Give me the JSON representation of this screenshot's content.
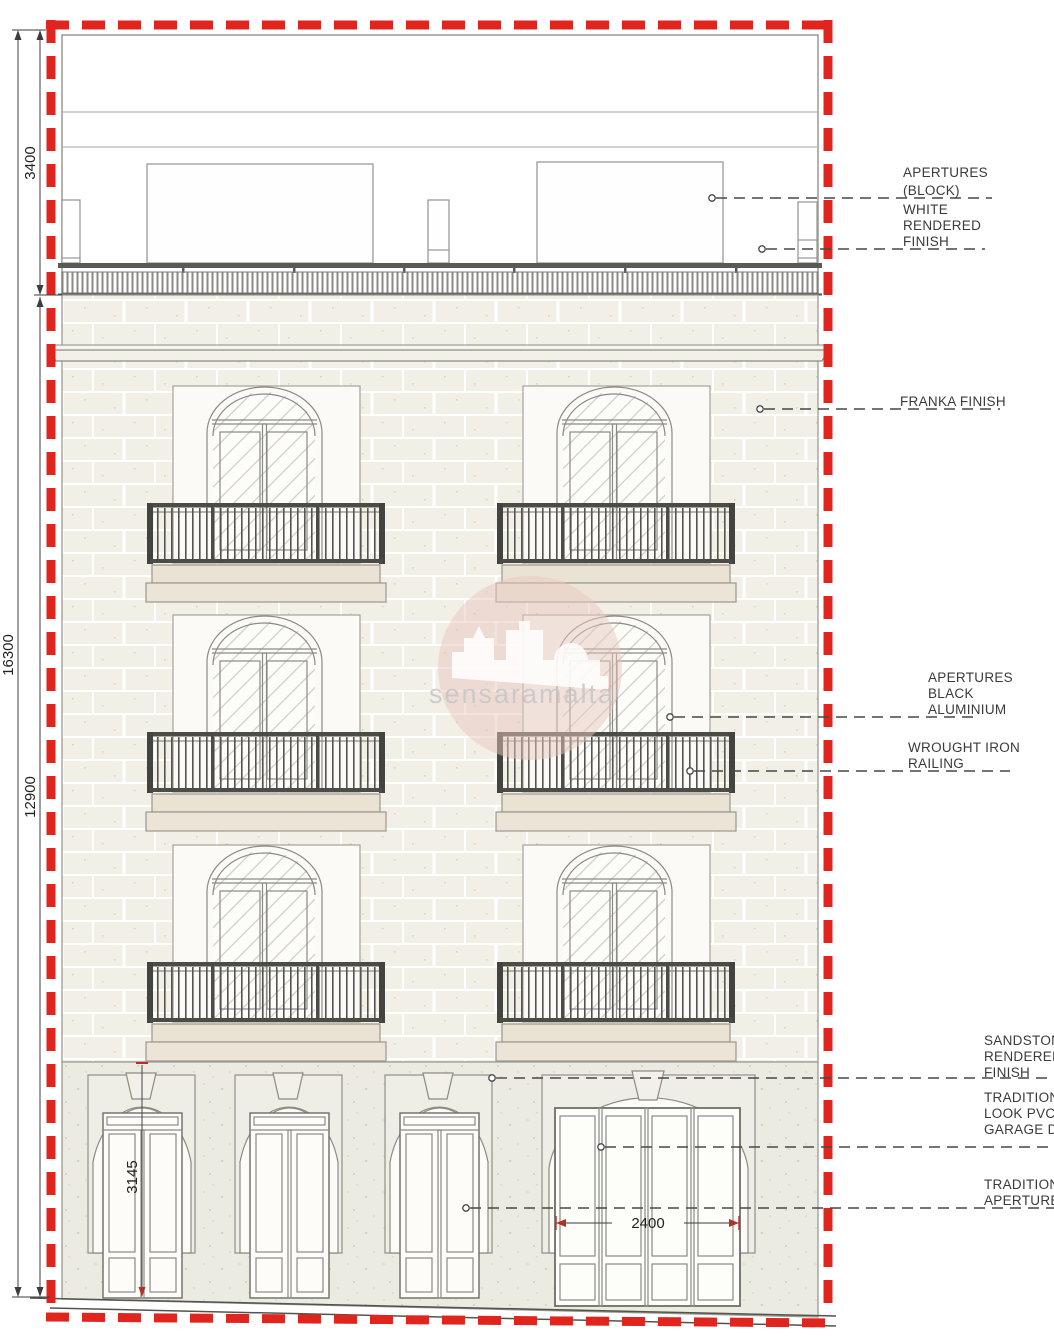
{
  "drawing": {
    "type": "front-elevation",
    "watermark": {
      "text": "sensaramalta"
    },
    "dimensions": {
      "roof_level_height": "3400",
      "total_height": "16300",
      "facade_height": "12900",
      "door_height": "3145",
      "garage_width": "2400"
    },
    "annotations": {
      "apertures_block": {
        "lines": [
          "APERTURES",
          "(BLOCK)"
        ]
      },
      "white_rendered_finish": {
        "lines": [
          "WHITE",
          "RENDERED",
          "FINISH"
        ]
      },
      "franka_finish": {
        "lines": [
          "FRANKA FINISH"
        ]
      },
      "apertures_black_aluminium": {
        "lines": [
          "APERTURES",
          "BLACK",
          "ALUMINIUM"
        ]
      },
      "wrought_iron_railing": {
        "lines": [
          "WROUGHT IRON",
          "RAILING"
        ]
      },
      "sandstone_rendered_finish": {
        "lines": [
          "SANDSTONE",
          "RENDERED",
          "FINISH"
        ]
      },
      "traditional_pvc_garage": {
        "lines": [
          "TRADITIONAL",
          "LOOK PVC",
          "GARAGE DOOR"
        ]
      },
      "traditional_apertures": {
        "lines": [
          "TRADITIONAL",
          "APERTURES"
        ]
      }
    },
    "colors": {
      "boundary_red": "#e0251f",
      "facade_stone": "#f2efe7",
      "ground_sandstone": "#ecebe2",
      "balcony_slab": "#eae2d2",
      "railing_dark": "#4c4c47",
      "line_gray": "#8b8b84",
      "watermark_pink": "#e7c7c0"
    }
  }
}
